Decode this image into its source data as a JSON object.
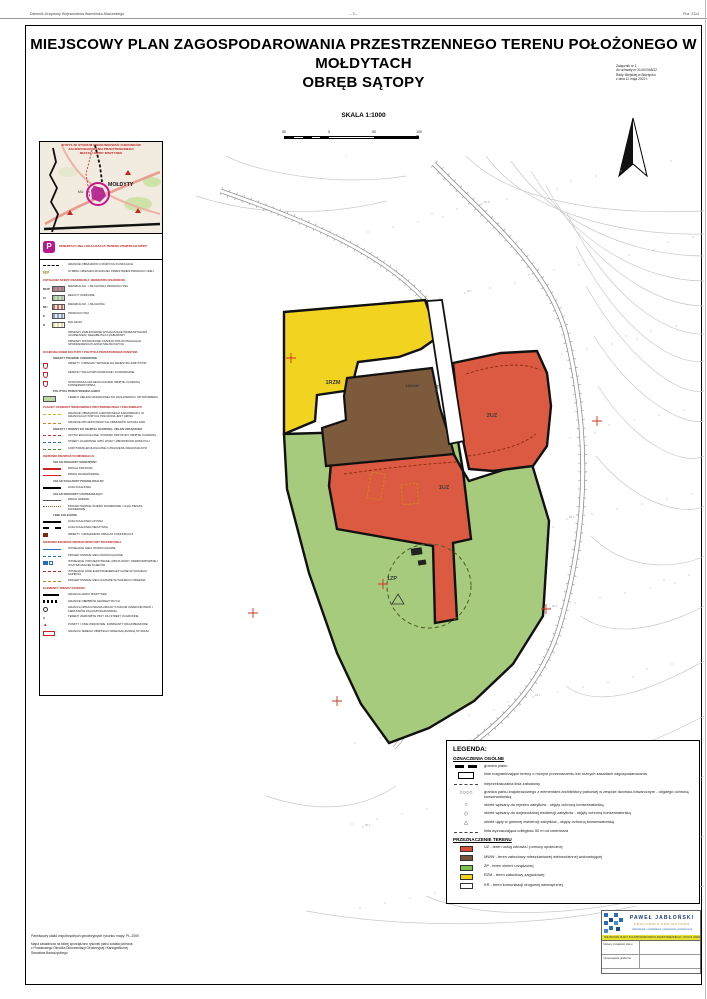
{
  "page_header": {
    "left": "Dziennik Urzędowy Województwa Warmińsko-Mazurskiego",
    "center": "– 3 –",
    "right": "Poz. 2114"
  },
  "title": {
    "line1": "MIEJSCOWY PLAN ZAGOSPODAROWANIA PRZESTRZENNEGO TERENU POŁOŻONEGO W MOŁDYTACH",
    "line2": "OBRĘB SĄTOPY"
  },
  "annotation": {
    "lines": [
      "Załącznik nr 1",
      "do uchwały nr XLVIII/348/22",
      "Rady Miejskiej w Bisztynku",
      "z dnia 11 maja 2022 r."
    ]
  },
  "scale": {
    "label": "SKALA 1:1000",
    "ticks": [
      {
        "pos": 0,
        "label": "50"
      },
      {
        "pos": 45,
        "label": "0"
      },
      {
        "pos": 90,
        "label": "50"
      },
      {
        "pos": 135,
        "label": "100 m"
      }
    ]
  },
  "sidebar": {
    "inset_title": [
      "WYRYS ZE STUDIUM UWARUNKOWAŃ I KIERUNKÓW",
      "ZAGOSPODAROWANIA PRZESTRZENNEGO",
      "MIASTA I GMINY BISZTYNEK"
    ],
    "inset_place": "MOŁDYTY",
    "inset_place2": "MU",
    "orientation_label": "ORIENTACYJNA LOKALIZACJA TERENU OBJĘTEGO MPZP",
    "rows": [
      {
        "t": "r",
        "s": "dash2",
        "l": "GRANICE OBSZARÓW O RÓŻNYCH FUNKCJACH"
      },
      {
        "t": "r",
        "s": "rp",
        "l": "SYMBOL OBSZARU ROLNICZEJ PRZESTRZENI PRODUKCYJNEJ"
      },
      {
        "t": "h",
        "l": "USTALENIA SFERY OSADNICZEJ: JEDNOSTKI OSADNICZE"
      },
      {
        "t": "r",
        "s": "sw1",
        "c": "MU/P",
        "l": "MIESZKALNO - USŁUGOWA I PRODUKCYJNA"
      },
      {
        "t": "r",
        "s": "sw2",
        "c": "ZI",
        "l": "RELIKTY PARKOWE"
      },
      {
        "t": "r",
        "s": "sw3",
        "c": "MU",
        "l": "MIESZKALNO - USŁUGOWA"
      },
      {
        "t": "r",
        "s": "sw4",
        "c": "P",
        "l": "PRODUKCYJNA"
      },
      {
        "t": "r",
        "s": "sw5",
        "c": "R",
        "l": "ROLNICZA"
      },
      {
        "t": "r",
        "s": "none",
        "l": "OBSZARY ZABUDOWANE WYMAGAJĄCE PRZEKSZTAŁCEŃ, UZUPEŁNIEŃ I REHABILITACJI ZABUDOWY"
      },
      {
        "t": "r",
        "s": "none",
        "l": "OBSZARY ROZWOJOWE OSADNICTWA WYMAGAJĄCE SPORZĄDZENIA PLANÓW MIEJSCOWYCH"
      },
      {
        "t": "h",
        "l": "OCHRONA DÓBR KULTURY I POLITYKA PRZESTRZENNA PAŃSTWA"
      },
      {
        "t": "h2",
        "l": "OBIEKTY PRAWNIE CHRONIONE"
      },
      {
        "t": "r",
        "s": "shield",
        "l": "OBIEKTY I OBSZARY WPISANE DO REJESTRU ZABYTKÓW"
      },
      {
        "t": "r",
        "s": "shield",
        "l": "ZESPOŁY PAŁACOWO-PARKOWE I FOLWARCZNE"
      },
      {
        "t": "r",
        "s": "shield",
        "l": "STANOWISKA ARCHEOLOGICZNE OBJĘTE OCHRONĄ KONSERWATORSKĄ"
      },
      {
        "t": "h2",
        "l": "POLITYKA PRZESTRZENNA GMINY"
      },
      {
        "t": "r",
        "s": "swg",
        "l": "TERENY ZIELENI URZĄDZONEJ DO ZACHOWANIA I ODTWORZENIA"
      },
      {
        "t": "h",
        "l": "ZASADY OCHRONY ŚRODOWISKA PRZYRODNICZEGO I KRAJOBRAZU"
      },
      {
        "t": "r",
        "s": "dy",
        "l": "GRANICE OBSZARÓW CHRONIONEGO KRAJOBRAZU, W GRANICACH KTÓRYCH POŁOŻONA JEST GMINA"
      },
      {
        "t": "r",
        "s": "do",
        "l": "GRANICE PROJEKTOWANYCH OBSZARÓW NATURA 2000"
      },
      {
        "t": "h2",
        "l": "OBIEKTY I TERENY DO OBJĘCIA OCHRONĄ: ZIELEŃ URZĄDZONA"
      },
      {
        "t": "r",
        "s": "dr",
        "l": "UŻYTKI EKOLOGICZNE I POMNIKI PRZYRODY OBJĘTE OCHRONĄ"
      },
      {
        "t": "r",
        "s": "db",
        "l": "STREFY OCHRONNE UJĘĆ WODY I ZBIORNIKÓW WODNYCH"
      },
      {
        "t": "r",
        "s": "dg",
        "l": "KORYTARZE EKOLOGICZNE O ZNACZENIU REGIONALNYM"
      },
      {
        "t": "h",
        "l": "KIERUNKI ROZWOJU KOMUNIKACJI"
      },
      {
        "t": "h2",
        "l": "UKŁAD DROGOWY NADRZĘDNY"
      },
      {
        "t": "r",
        "s": "lr1",
        "l": "DROGA KRAJOWA"
      },
      {
        "t": "r",
        "s": "lr2",
        "l": "DROGI WOJEWÓDZKIE"
      },
      {
        "t": "h2",
        "l": "UKŁAD KOLEJOWY PONADLOKALNY"
      },
      {
        "t": "r",
        "s": "lh",
        "l": "LINIA KOLEJOWA"
      },
      {
        "t": "h2",
        "l": "UKŁAD DROGOWY UZUPEŁNIAJĄCY"
      },
      {
        "t": "r",
        "s": "lk",
        "l": "DROGI GMINNE"
      },
      {
        "t": "r",
        "s": "dots",
        "l": "PROJEKTOWANE ŚCIEŻKI ROWEROWE I CIĄGI PIESZO-ROWEROWE"
      },
      {
        "t": "h2",
        "l": "LINIE KOLEJOWE"
      },
      {
        "t": "r",
        "s": "lh",
        "l": "LINIA KOLEJOWA CZYNNA"
      },
      {
        "t": "r",
        "s": "lh2",
        "l": "LINIA KOLEJOWA NIECZYNNA"
      },
      {
        "t": "r",
        "s": "dk",
        "l": "OBIEKTY I URZĄDZENIA OBSŁUGI KOMUNIKACJI"
      },
      {
        "t": "h",
        "l": "KIERUNKI ROZWOJU INFRASTRUKTURY TECHNICZNEJ"
      },
      {
        "t": "r",
        "s": "lb",
        "l": "ISTNIEJĄCE SIECI WODOCIĄGOWE"
      },
      {
        "t": "r",
        "s": "lbd",
        "l": "PROJEKTOWANE SIECI WODOCIĄGOWE"
      },
      {
        "t": "r",
        "s": "sqb",
        "l": "ISTNIEJĄCE I PROJEKTOWANE UJĘCIA WODY, PRZEPOMPOWNIE I OCZYSZCZALNIE ŚCIEKÓW"
      },
      {
        "t": "r",
        "s": "lrd",
        "l": "ISTNIEJĄCE LINIE ELEKTROENERGETYCZNE WYSOKIEGO NAPIĘCIA"
      },
      {
        "t": "r",
        "s": "lod",
        "l": "PROJEKTOWANE SIECI GAZOWE WYSOKIEGO CIŚNIENIA"
      },
      {
        "t": "h",
        "l": "ELEMENTY ZMIANY STUDIUM"
      },
      {
        "t": "r",
        "s": "lbk",
        "l": "GRANICA GMINY BISZTYNEK"
      },
      {
        "t": "r",
        "s": "lhk",
        "l": "GRANICE OBRĘBÓW GEODEZYJNYCH"
      },
      {
        "t": "r",
        "s": "circ",
        "l": "GRANICA OPRACOWANIA ZMIANY STUDIUM UWARUNKOWAŃ I KIERUNKÓW ZAGOSPODAROWANIA"
      },
      {
        "t": "r",
        "s": "no2",
        "l": "TERENY ZAMKNIĘTE PKP I ICH STREFY OCHRONNE"
      },
      {
        "t": "r",
        "s": "tri",
        "l": "PUNKTY I OSIE WIDOKOWE, DOMINANTY KRAJOBRAZOWE"
      },
      {
        "t": "r",
        "s": "boxr",
        "l": "GRANICA TERENU OBJĘTEGO NINIEJSZĄ ZMIANĄ STUDIUM"
      }
    ]
  },
  "map": {
    "labels": [
      {
        "code": "1RZM",
        "x": 167,
        "y": 228,
        "size": 5.5,
        "rot": 0
      },
      {
        "code": "1MWW",
        "x": 246,
        "y": 231,
        "size": 4,
        "rot": 0
      },
      {
        "code": "2UZ",
        "x": 326,
        "y": 261,
        "size": 5.5,
        "rot": 0
      },
      {
        "code": "1UZ",
        "x": 278,
        "y": 333,
        "size": 5.5,
        "rot": 0
      },
      {
        "code": "1ZP",
        "x": 226,
        "y": 424,
        "size": 5.5,
        "rot": 0
      },
      {
        "code": "1KR",
        "x": 272,
        "y": 233,
        "size": 4,
        "rot": -78
      }
    ]
  },
  "legend": {
    "title": "LEGENDA:",
    "general_title": "OZNACZENIA OGÓLNE",
    "general": [
      {
        "s": "boundary",
        "l": "granica planu"
      },
      {
        "s": "rect",
        "l": "linie rozgraniczające tereny o różnym przeznaczeniu lub różnych zasadach zagospodarowania"
      },
      {
        "s": "dashdot",
        "l": "nieprzekraczalna linia zabudowy"
      },
      {
        "s": "circles",
        "l": "granica parku krajobrazowego z elementami architektury parkowej w zespole dworsko-folwarcznym - objętego ochroną konserwatorską"
      },
      {
        "s": "ring",
        "l": "obiekt wpisany do rejestru zabytków - objęty ochroną konserwatorską"
      },
      {
        "s": "diamond",
        "l": "obiekt wpisany do wojewódzkiej ewidencji zabytków - objęty ochroną konserwatorską"
      },
      {
        "s": "triangle",
        "l": "obiekt ujęty w gminnej ewidencji zabytków - objęty ochroną konserwatorską"
      },
      {
        "s": "dashdot",
        "l": "linia wyznaczająca odległość 50 m od cmentarza"
      }
    ],
    "dest_title": "PRZEZNACZENIE TERENU",
    "dest": [
      {
        "color": "#d94e35",
        "l": "UZ - teren usług zdrowia i pomocy społecznej"
      },
      {
        "color": "#7a5036",
        "l": "MWW - teren zabudowy mieszkaniowej wielorodzinnej wolnostojącej"
      },
      {
        "color": "#7dc14f",
        "l": "ZP - teren zieleni urządzonej"
      },
      {
        "color": "#f2d31b",
        "l": "RZM - teren zabudowy zagrodowej"
      },
      {
        "color": "#ffffff",
        "l": "KR - teren komunikacji drogowej wewnętrznej"
      }
    ]
  },
  "stamp": {
    "name": "PAWEŁ JABŁOŃSKI",
    "subtitle": "PRACOWNIA PROJEKTOWA",
    "contact": "urbanistyka  •  architektura  •  planowanie przestrzenne",
    "bar": "MIEJSCOWE PLANY ZAGOSPODAROWANIA PRZESTRZENNEGO • STUDIA UWARUNKOWAŃ",
    "rows": [
      {
        "label": "Główny projektant planu"
      },
      {
        "label": "Opracowanie graficzne"
      }
    ]
  },
  "footnotes": {
    "line1": "Państwowy układ współrzędnych geodezyjnych rysunku mapy: PL-2000",
    "block": [
      "Mapa zasadnicza na której sporządzono rysunek planu została pobrana",
      "z Powiatowego Ośrodka Dokumentacji Geodezyjnej i Kartograficznej",
      "Starostwa Bartoszyckiego"
    ]
  },
  "colors": {
    "zone_rzm": "#f2d31f",
    "zone_uz": "#dc5a41",
    "zone_mww": "#7d5a3c",
    "zone_zp": "#a6cb7c",
    "accent_red": "#c02020",
    "magenta": "#b81a8e"
  }
}
